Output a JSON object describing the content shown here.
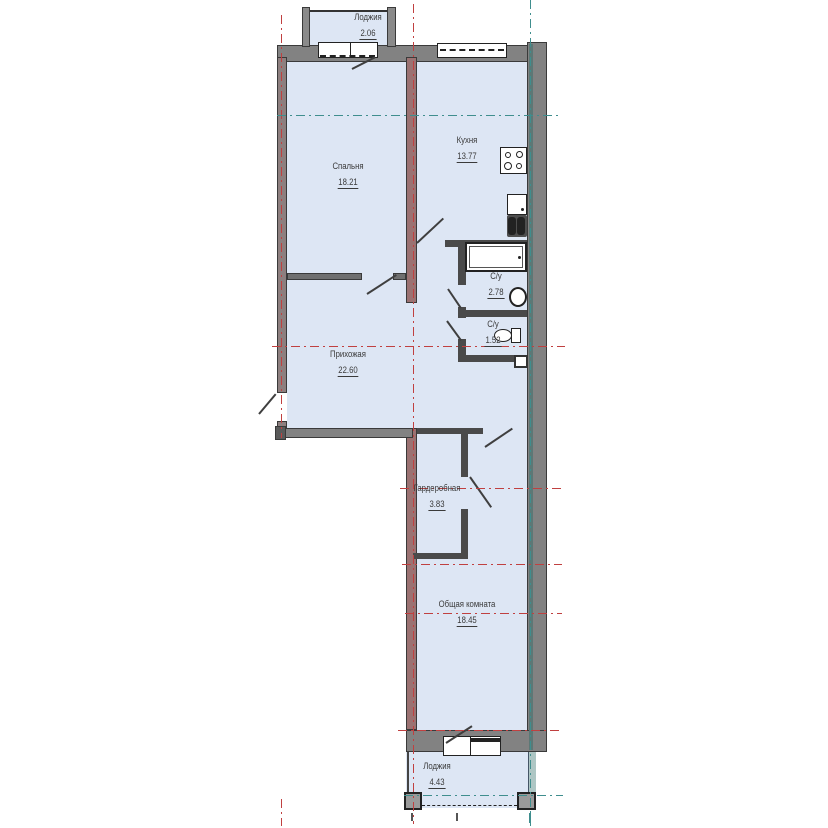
{
  "plan_title": "apartment-floor-plan",
  "rooms": {
    "loggia_top": {
      "name": "Лоджия",
      "area": "2.06"
    },
    "bedroom": {
      "name": "Спальня",
      "area": "18.21"
    },
    "kitchen": {
      "name": "Кухня",
      "area": "13.77"
    },
    "bathroom": {
      "name": "С/у",
      "area": "2.78"
    },
    "toilet": {
      "name": "С/у",
      "area": "1.52"
    },
    "hallway": {
      "name": "Прихожая",
      "area": "22.60"
    },
    "wardrobe": {
      "name": "Гардеробная",
      "area": "3.83"
    },
    "living_room": {
      "name": "Общая комната",
      "area": "18.45"
    },
    "loggia_bottom": {
      "name": "Лоджия",
      "area": "4.43"
    }
  },
  "fixtures": [
    "stove-icon",
    "kitchen-sink-icon",
    "bathtub-icon",
    "washbasin-icon",
    "toilet-icon",
    "vent-shaft"
  ],
  "colors": {
    "room_fill": "#dde6f4",
    "wall_gray": "#828282",
    "wall_bearing": "#9b7272",
    "wall_partition": "#4a4a4a",
    "axis_red": "#c04040",
    "axis_teal": "#3f8e8e",
    "text": "#3a3a3a"
  }
}
